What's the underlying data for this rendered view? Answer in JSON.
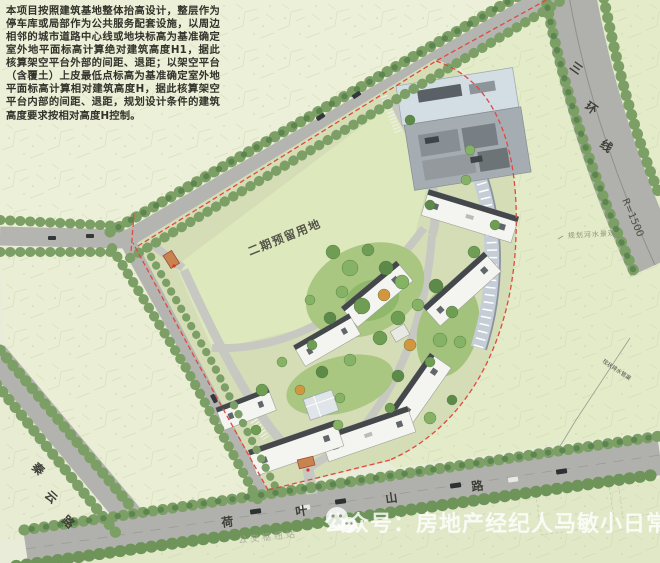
{
  "note": {
    "text": "本项目按照建筑基地整体抬高设计，整层作为停车库或局部作为公共服务配套设施，以周边相邻的城市道路中心线或地块标高为基准确定室外地平面标高计算绝对建筑高度H1，据此核算架空平台外部的间距、退距；以架空平台（含覆土）上皮最低点标高为基准确定室外地平面标高计算相对建筑高度H，据此核算架空平台内部的间距、退距，规划设计条件的建筑高度要求按相对高度H控制。"
  },
  "plan": {
    "phase2_label": "二期预留用地"
  },
  "roads": {
    "ring": {
      "name": "三环线",
      "chars": [
        "三",
        "环",
        "线"
      ],
      "radius_label": "R=1500"
    },
    "qinyun": {
      "name": "秦云路",
      "chars": [
        "秦",
        "云",
        "路"
      ]
    },
    "heyeshan": {
      "name": "荷叶山路",
      "chars": [
        "荷",
        "叶",
        "山",
        "路"
      ]
    }
  },
  "annotations": {
    "water": "规划河水景观",
    "drain": "现状排水管渠",
    "bus": "公交枢纽站"
  },
  "watermark": {
    "label": "公众号：房地产经纪人马敏小日常",
    "icon": "wechat-icon"
  },
  "colors": {
    "boundary_red": "#e0493f",
    "road_gray": "#b2b3ae",
    "field_green": "#dde8bd",
    "tree_green": "#7c9f66",
    "lawn_green": "#a9c781"
  }
}
